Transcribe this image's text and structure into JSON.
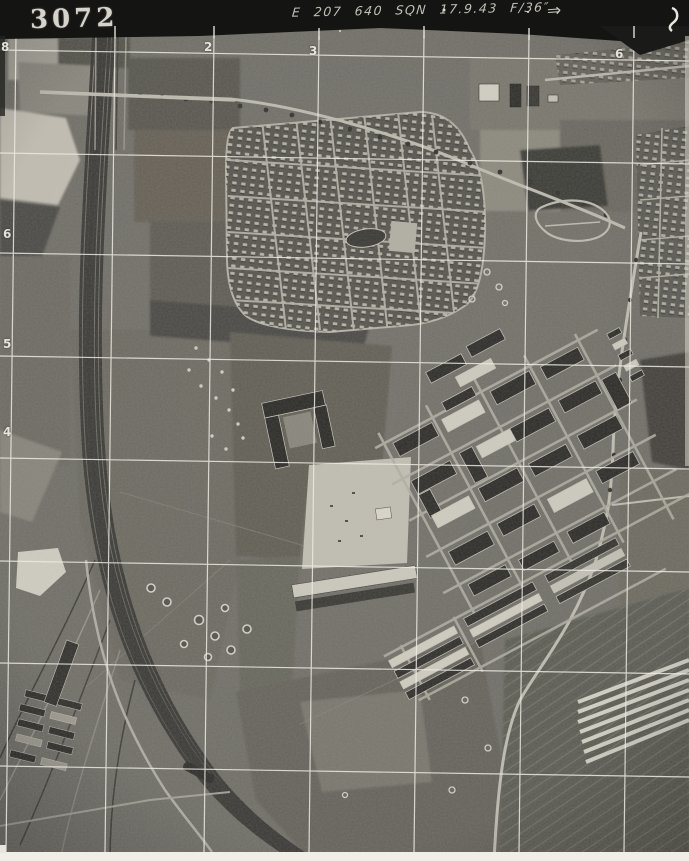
{
  "header": {
    "photo_number": "3072",
    "annotation": "E 207 640 SQN 17.9.43 F/36″",
    "arrow": "⇒"
  },
  "grid": {
    "top": [
      "8",
      "2",
      "3",
      "6"
    ],
    "left": [
      "6",
      "5",
      "4"
    ]
  },
  "photo_features": [
    "railway-yard",
    "railway-sidings",
    "road-overbridge",
    "housing-estate",
    "estate-pond",
    "tree-lined-road",
    "loop-road-junction",
    "barracks-complex",
    "parade-ground",
    "bomb-craters",
    "field-patchwork",
    "suburb-street-grid",
    "main-road",
    "goods-train",
    "greenhouse-rows",
    "allotment-strips"
  ],
  "colors": {
    "paper": "#f1eee7",
    "header_band": "#141412",
    "photo_base": "#73716a",
    "grid_line": "#eceae3",
    "stamp_ink": "#e6e4db"
  }
}
